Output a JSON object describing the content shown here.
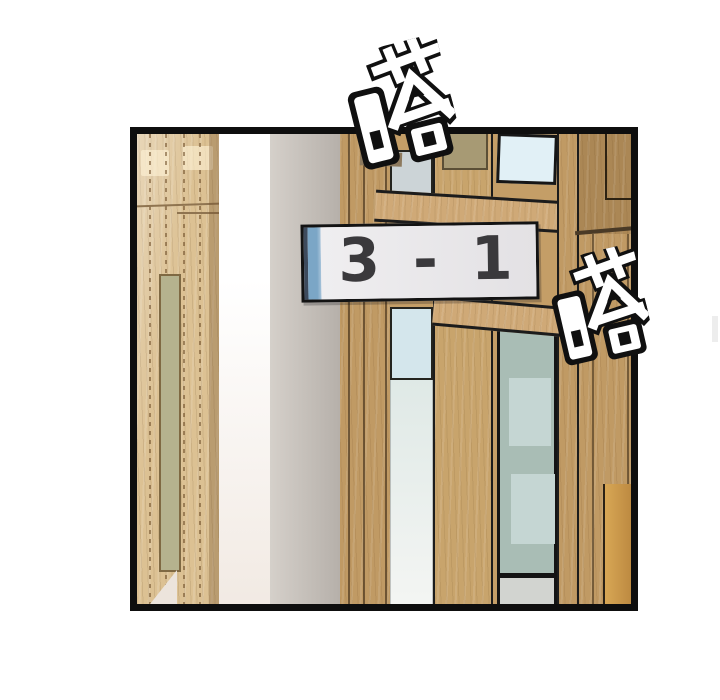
{
  "sign": {
    "text": "3 - 1"
  },
  "sfx": {
    "top": "嗒",
    "right": "嗒"
  },
  "palette": {
    "panel-border": "#0e0e0e",
    "wood-base": "#c49e67",
    "wood-light": "#dcc193",
    "wood-mid": "#c09a64",
    "wood-stile": "#c8a46c",
    "wood-rail": "#cfa977",
    "wood-dark": "#ab8755",
    "wood-orange-1": "#d8a755",
    "wood-orange-2": "#bd8a41",
    "seam-brown": "#8f7450",
    "door-inset-green": "#b5b28e",
    "wedge-light": "#ece4dc",
    "gap-white-1": "#ffffff",
    "gap-white-2": "#f1e9e2",
    "wall-gray-1": "#d5d0ca",
    "wall-gray-2": "#b6b0aa",
    "glass-bright": "#e1f0f6",
    "glass-muted": "#ccd4d7",
    "glass-mid-blue": "#d4e6ec",
    "glass-pale-1": "#dfe9e6",
    "glass-pale-2": "#f5f6f4",
    "glass-green": "#a9bdb5",
    "glass-green-light": "#c5d6d3",
    "glass-bottom-gray": "#d2d4d0",
    "olive-panel": "#a79a74",
    "recess-brown": "#8d7a5e",
    "outline-dark": "#1c1c1c",
    "sign-plate": "#efeef0",
    "sign-plate-2": "#e3e1e4",
    "sign-stripe": "#7ba6c6",
    "sign-stripe-dark": "#3d4a5c",
    "sign-text": "#3a393c",
    "sign-outline": "#131313",
    "sfx-fill": "#ffffff",
    "sfx-outline": "#101010"
  }
}
